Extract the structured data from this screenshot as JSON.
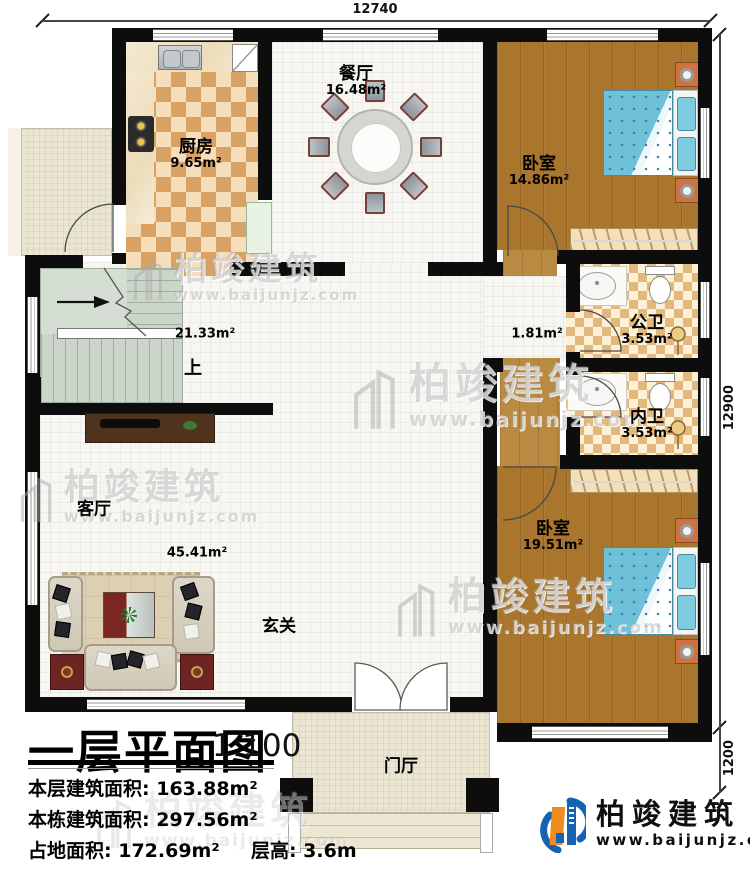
{
  "dimensions": {
    "top": "12740",
    "right_main": "12900",
    "right_lower": "1200"
  },
  "rooms": {
    "kitchen": {
      "name": "厨房",
      "area": "9.65m²"
    },
    "dining": {
      "name": "餐厅",
      "area": "16.48m²"
    },
    "bedroom_top": {
      "name": "卧室",
      "area": "14.86m²"
    },
    "public_bath": {
      "name": "公卫",
      "area": "3.53m²"
    },
    "inner_bath": {
      "name": "内卫",
      "area": "3.53m²"
    },
    "bedroom_bottom": {
      "name": "卧室",
      "area": "19.51m²"
    },
    "living": {
      "name": "客厅",
      "area": "45.41m²"
    },
    "hall_area": "21.33m²",
    "corridor_area": "1.81m²",
    "entry": "玄关",
    "porch": "门厅",
    "stairs_up": "上"
  },
  "title_block": {
    "title": "一层平面图",
    "scale": "1:100",
    "rows": [
      {
        "label": "本层建筑面积:",
        "value": "163.88m²"
      },
      {
        "label": "本栋建筑面积:",
        "value": "297.56m²"
      },
      {
        "label": "占地面积:",
        "value": "172.69m²",
        "label2": "层高:",
        "value2": "3.6m"
      }
    ]
  },
  "watermark": {
    "brand": "柏竣建筑",
    "url": "www.baijunjz.com"
  },
  "logo": {
    "brand": "柏竣建筑",
    "url": "www.baijunjz.com"
  },
  "colors": {
    "wall": "#0d0d0d",
    "wood_floor": "#aa752d",
    "kitchen_tile_light": "#f6debb",
    "kitchen_tile_dark": "#d7a264",
    "bed_blue": "#6fc1d9",
    "stair_green": "#ccd5ca",
    "logo_blue": "#1663b4",
    "logo_orange": "#f08c1e"
  }
}
